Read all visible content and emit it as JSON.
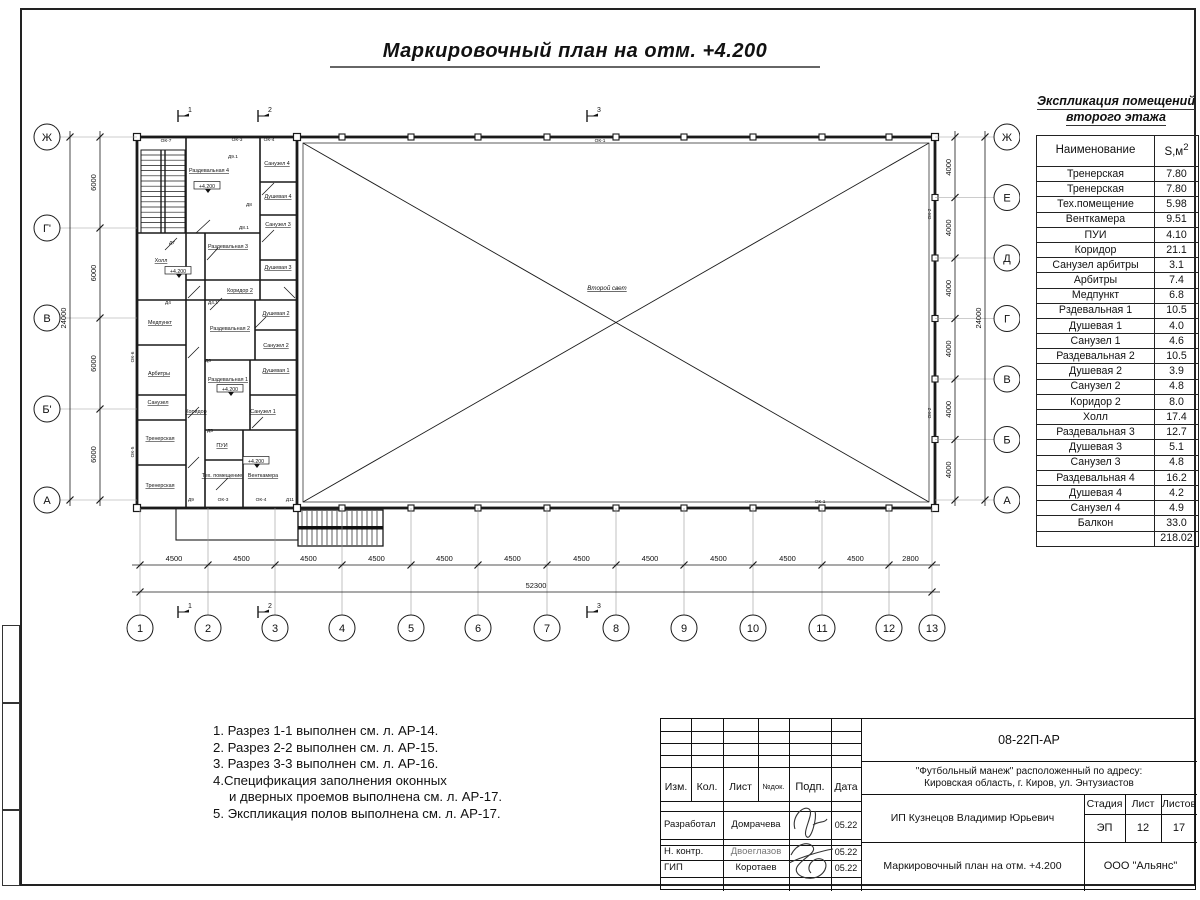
{
  "sheet": {
    "title": "Маркировочный план на отм. +4.200"
  },
  "explication": {
    "title_line1": "Экспликация помещений",
    "title_line2": "второго этажа",
    "col_name": "Наименование",
    "col_area": "S,м",
    "col_area_sup": "2",
    "rows": [
      [
        "Тренерская",
        "7.80"
      ],
      [
        "Тренерская",
        "7.80"
      ],
      [
        "Тех.помещение",
        "5.98"
      ],
      [
        "Венткамера",
        "9.51"
      ],
      [
        "ПУИ",
        "4.10"
      ],
      [
        "Коридор",
        "21.1"
      ],
      [
        "Санузел арбитры",
        "3.1"
      ],
      [
        "Арбитры",
        "7.4"
      ],
      [
        "Медпункт",
        "6.8"
      ],
      [
        "Рздевальная 1",
        "10.5"
      ],
      [
        "Душевая 1",
        "4.0"
      ],
      [
        "Санузел 1",
        "4.6"
      ],
      [
        "Раздевальная 2",
        "10.5"
      ],
      [
        "Душевая 2",
        "3.9"
      ],
      [
        "Санузел 2",
        "4.8"
      ],
      [
        "Коридор 2",
        "8.0"
      ],
      [
        "Холл",
        "17.4"
      ],
      [
        "Раздевальная 3",
        "12.7"
      ],
      [
        "Душевая 3",
        "5.1"
      ],
      [
        "Санузел 3",
        "4.8"
      ],
      [
        "Раздевальная 4",
        "16.2"
      ],
      [
        "Душевая 4",
        "4.2"
      ],
      [
        "Санузел 4",
        "4.9"
      ],
      [
        "Балкон",
        "33.0"
      ],
      [
        "",
        "218.02"
      ]
    ]
  },
  "notes": [
    {
      "t": "1. Разрез 1-1 выполнен см. л. АР-14.",
      "ind": 0
    },
    {
      "t": "2. Разрез 2-2 выполнен см. л. АР-15.",
      "ind": 0
    },
    {
      "t": "3. Разрез 3-3 выполнен см. л. АР-16.",
      "ind": 0
    },
    {
      "t": "4.Спецификация заполнения оконных",
      "ind": 0
    },
    {
      "t": "и дверных проемов выполнена см. л. АР-17.",
      "ind": 1
    },
    {
      "t": "5. Экспликация полов выполнена см. л. АР-17.",
      "ind": 0
    }
  ],
  "plan": {
    "axes_left": [
      "Ж",
      "Г'",
      "В",
      "Б'",
      "А"
    ],
    "axes_right": [
      "Ж",
      "Е",
      "Д",
      "Г",
      "В",
      "Б",
      "А"
    ],
    "cols": [
      "1",
      "2",
      "3",
      "4",
      "5",
      "6",
      "7",
      "8",
      "9",
      "10",
      "11",
      "12",
      "13"
    ],
    "dims_bottom": [
      "4500",
      "4500",
      "4500",
      "4500",
      "4500",
      "4500",
      "4500",
      "4500",
      "4500",
      "4500",
      "4500",
      "2800"
    ],
    "dim_total_bottom": "52300",
    "dims_left": [
      "6000",
      "6000",
      "6000",
      "6000"
    ],
    "dim_total_left": "24000",
    "dims_right": [
      "4000",
      "4000",
      "4000",
      "4000",
      "4000",
      "4000"
    ],
    "dim_total_right": "24000",
    "section_marks": [
      "1",
      "2",
      "3"
    ],
    "void_label": "Второй свет",
    "level_mark": "+4.200",
    "rooms": [
      {
        "t": "Раздевальная 4",
        "x": 209,
        "y": 172
      },
      {
        "t": "Санузел 4",
        "x": 277,
        "y": 165
      },
      {
        "t": "Душевая 4",
        "x": 278,
        "y": 198
      },
      {
        "t": "Санузел 3",
        "x": 278,
        "y": 226
      },
      {
        "t": "Раздевальная 3",
        "x": 228,
        "y": 248
      },
      {
        "t": "Душевая 3",
        "x": 278,
        "y": 269
      },
      {
        "t": "Коридор 2",
        "x": 240,
        "y": 292
      },
      {
        "t": "Холл",
        "x": 161,
        "y": 262
      },
      {
        "t": "Медпункт",
        "x": 160,
        "y": 324
      },
      {
        "t": "Арбитры",
        "x": 159,
        "y": 375
      },
      {
        "t": "Санузел",
        "x": 158,
        "y": 404
      },
      {
        "t": "Тренерская",
        "x": 160,
        "y": 440
      },
      {
        "t": "Тренерская",
        "x": 160,
        "y": 487
      },
      {
        "t": "Коридор",
        "x": 196,
        "y": 413
      },
      {
        "t": "Раздевальная 2",
        "x": 230,
        "y": 330
      },
      {
        "t": "Душевая 2",
        "x": 276,
        "y": 315
      },
      {
        "t": "Санузел 2",
        "x": 276,
        "y": 347
      },
      {
        "t": "Раздевальная 1",
        "x": 228,
        "y": 381
      },
      {
        "t": "Душевая 1",
        "x": 276,
        "y": 372
      },
      {
        "t": "Санузел 1",
        "x": 263,
        "y": 413
      },
      {
        "t": "ПУИ",
        "x": 222,
        "y": 447
      },
      {
        "t": "Тех. помещение",
        "x": 222,
        "y": 477
      },
      {
        "t": "Венткамера",
        "x": 263,
        "y": 477
      }
    ],
    "levels": [
      {
        "x": 207,
        "y": 187
      },
      {
        "x": 230,
        "y": 390
      },
      {
        "x": 256,
        "y": 462
      },
      {
        "x": 178,
        "y": 272
      }
    ],
    "tags": [
      {
        "t": "ОК-7",
        "x": 166,
        "y": 142
      },
      {
        "t": "ОК-3",
        "x": 237,
        "y": 141
      },
      {
        "t": "ОК-4",
        "x": 269,
        "y": 141
      },
      {
        "t": "Д9",
        "x": 191,
        "y": 501
      },
      {
        "t": "ОК-3",
        "x": 223,
        "y": 501
      },
      {
        "t": "ОК-4",
        "x": 261,
        "y": 501
      },
      {
        "t": "Д11",
        "x": 290,
        "y": 501
      },
      {
        "t": "ОК-6",
        "x": 134,
        "y": 357,
        "r": 1
      },
      {
        "t": "ОК-5",
        "x": 134,
        "y": 452,
        "r": 1
      },
      {
        "t": "ОК-2",
        "x": 931,
        "y": 214,
        "r": 1
      },
      {
        "t": "ОК-2",
        "x": 931,
        "y": 413,
        "r": 1
      },
      {
        "t": "ОК-1",
        "x": 600,
        "y": 142
      },
      {
        "t": "ОК-1",
        "x": 820,
        "y": 503
      },
      {
        "t": "Д9.1",
        "x": 233,
        "y": 158
      },
      {
        "t": "Д8",
        "x": 249,
        "y": 206
      },
      {
        "t": "Д8.1",
        "x": 244,
        "y": 229
      },
      {
        "t": "Д7",
        "x": 172,
        "y": 244
      },
      {
        "t": "Д4",
        "x": 168,
        "y": 304
      },
      {
        "t": "Д4.1",
        "x": 213,
        "y": 304
      },
      {
        "t": "Д6",
        "x": 208,
        "y": 362
      },
      {
        "t": "Д5",
        "x": 210,
        "y": 432
      }
    ]
  },
  "titleblock": {
    "doc_number": "08-22П-АР",
    "project_line1": "\"Футбольный манеж\" расположенный по адресу:",
    "project_line2": "Кировская область, г. Киров, ул. Энтузиастов",
    "client": "ИП Кузнецов Владимир Юрьевич",
    "sheet_title": "Маркировочный план на отм. +4.200",
    "company": "ООО \"Альянс\"",
    "stage_label": "Стадия",
    "sheet_label": "Лист",
    "sheets_label": "Листов",
    "stage": "ЭП",
    "sheet": "12",
    "sheets": "17",
    "cols": [
      "Изм.",
      "Кол.",
      "Лист",
      "№док.",
      "Подп.",
      "Дата"
    ],
    "rows": [
      {
        "role": "Разработал",
        "name": "Домрачева",
        "date": "05.22"
      },
      {
        "role": "Н. контр.",
        "name": "Двоеглазов",
        "date": "05.22"
      },
      {
        "role": "ГИП",
        "name": "Коротаев",
        "date": "05.22"
      }
    ]
  }
}
